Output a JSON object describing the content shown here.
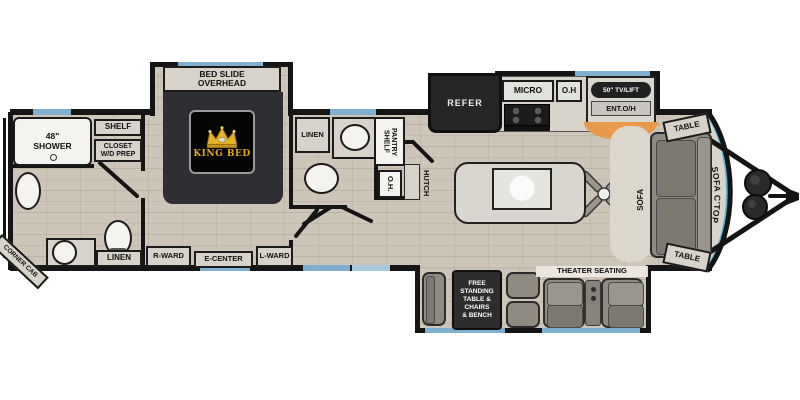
{
  "colors": {
    "wall": "#151515",
    "window": "#7fb0d2",
    "window2": "#a9c9de",
    "floor": "#cdc5b7",
    "counter": "#d7d3cb",
    "furn": "#8f8b83",
    "furn-dark": "#7d7971",
    "dark": "#262626",
    "orange": "#e9994a",
    "cap": "#54b5df",
    "gold": "#e2a91c",
    "bed": "#2f2f33",
    "white": "#f4f3f0"
  },
  "rear_bath": {
    "shower": "48\"\nSHOWER",
    "shelf": "SHELF",
    "closet": "CLOSET\nW/D PREP",
    "corner_cab": "CORNER CAB",
    "linen": "LINEN"
  },
  "bedroom": {
    "bed_slide": "BED SLIDE\nOVERHEAD",
    "king_bed": "KING BED",
    "r_ward": "R-WARD",
    "e_center": "E-CENTER",
    "l_ward": "L-WARD"
  },
  "mid_bath": {
    "linen": "LINEN",
    "pantry": "PANTRY\nSHELF",
    "oh": "O.H.",
    "hutch": "HUTCH"
  },
  "kitchen": {
    "refer": "REFER",
    "micro": "MICRO",
    "oh": "O.H",
    "tv_lift": "50\" TV/LIFT",
    "ent_oh": "ENT.O/H"
  },
  "living": {
    "table_top": "TABLE",
    "sofa": "SOFA",
    "sofa_ctop": "SOFA C'TOP",
    "table_bottom": "TABLE",
    "theater": "THEATER SEATING"
  },
  "dinette": {
    "free_standing": "FREE\nSTANDING\nTABLE &\nCHAIRS\n& BENCH"
  }
}
